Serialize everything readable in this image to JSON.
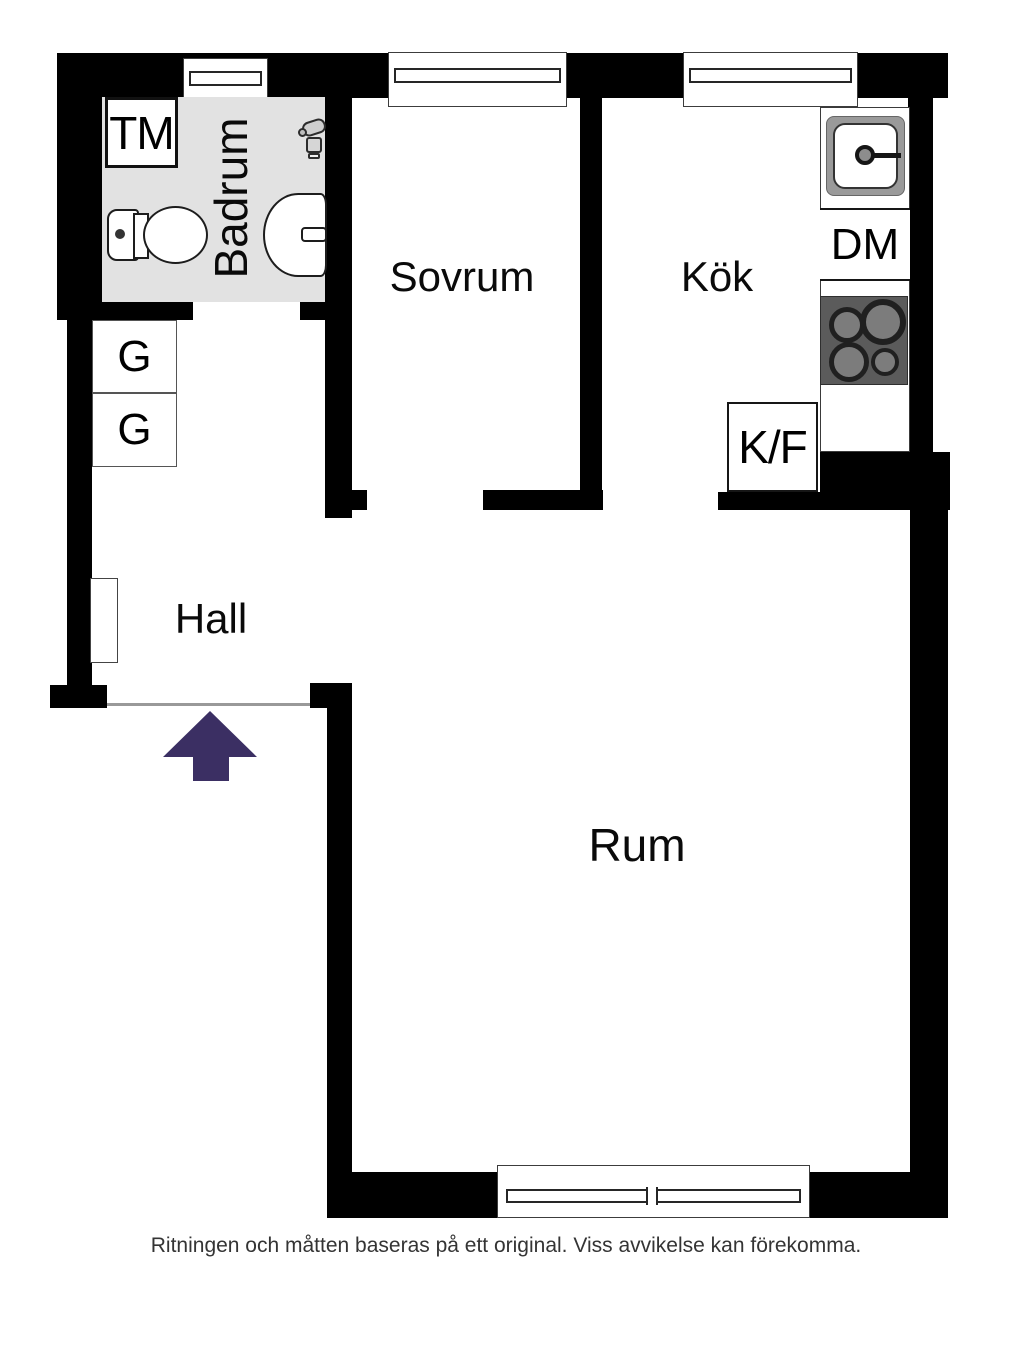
{
  "plan": {
    "rooms": {
      "badrum": "Badrum",
      "sovrum": "Sovrum",
      "kok": "Kök",
      "hall": "Hall",
      "rum": "Rum"
    },
    "appliances": {
      "tm": "TM",
      "dm": "DM",
      "kf": "K/F",
      "g_top": "G",
      "g_bottom": "G"
    },
    "icons": [
      "toilet-icon",
      "bathroom-sink-icon",
      "faucet-icon",
      "kitchen-sink-icon",
      "stove-burners-icon",
      "entrance-arrow-icon",
      "window-symbol"
    ],
    "colors": {
      "wall": "#000000",
      "bathroom_floor": "#e2e2e2",
      "entrance_arrow": "#3b2f63",
      "stove": "#5b5b5b",
      "threshold": "#999999"
    }
  },
  "caption": "Ritningen och måtten baseras på ett original. Viss avvikelse kan förekomma."
}
